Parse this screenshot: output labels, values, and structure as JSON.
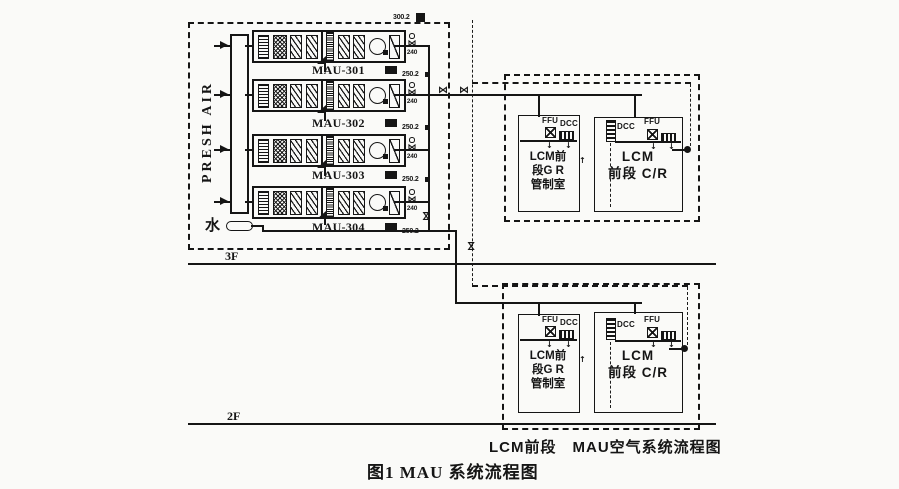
{
  "colors": {
    "ink": "#151515",
    "paper": "#fafaf8"
  },
  "labels": {
    "fresh_air": "PRESH AIR",
    "water": "水",
    "floor3": "3F",
    "floor2": "2F",
    "top_duct_tag": "300.2"
  },
  "icons": {
    "down_arrow": "↓",
    "up_arrow": "↑",
    "valve": "⋈"
  },
  "mau_units": [
    {
      "label": "MAU-301",
      "duct_tag": "250.2",
      "flow": "240"
    },
    {
      "label": "MAU-302",
      "duct_tag": "250.2",
      "flow": "240"
    },
    {
      "label": "MAU-303",
      "duct_tag": "250.2",
      "flow": "240"
    },
    {
      "label": "MAU-304",
      "duct_tag": "250.2",
      "flow": "240"
    }
  ],
  "lcm_boxes": [
    {
      "left_room": {
        "ffu": "FFU",
        "dcc": "DCC",
        "name1": "LCM前",
        "name2": "段G R",
        "name3": "管制室"
      },
      "right_room": {
        "dcc": "DCC",
        "ffu": "FFU",
        "name1": "LCM",
        "name2": "前段 C/R"
      }
    },
    {
      "left_room": {
        "ffu": "FFU",
        "dcc": "DCC",
        "name1": "LCM前",
        "name2": "段G R",
        "name3": "管制室"
      },
      "right_room": {
        "dcc": "DCC",
        "ffu": "FFU",
        "name1": "LCM",
        "name2": "前段 C/R"
      }
    }
  ],
  "captions": {
    "sub": "LCM前段　MAU空气系统流程图",
    "main": "图1 MAU 系统流程图"
  }
}
